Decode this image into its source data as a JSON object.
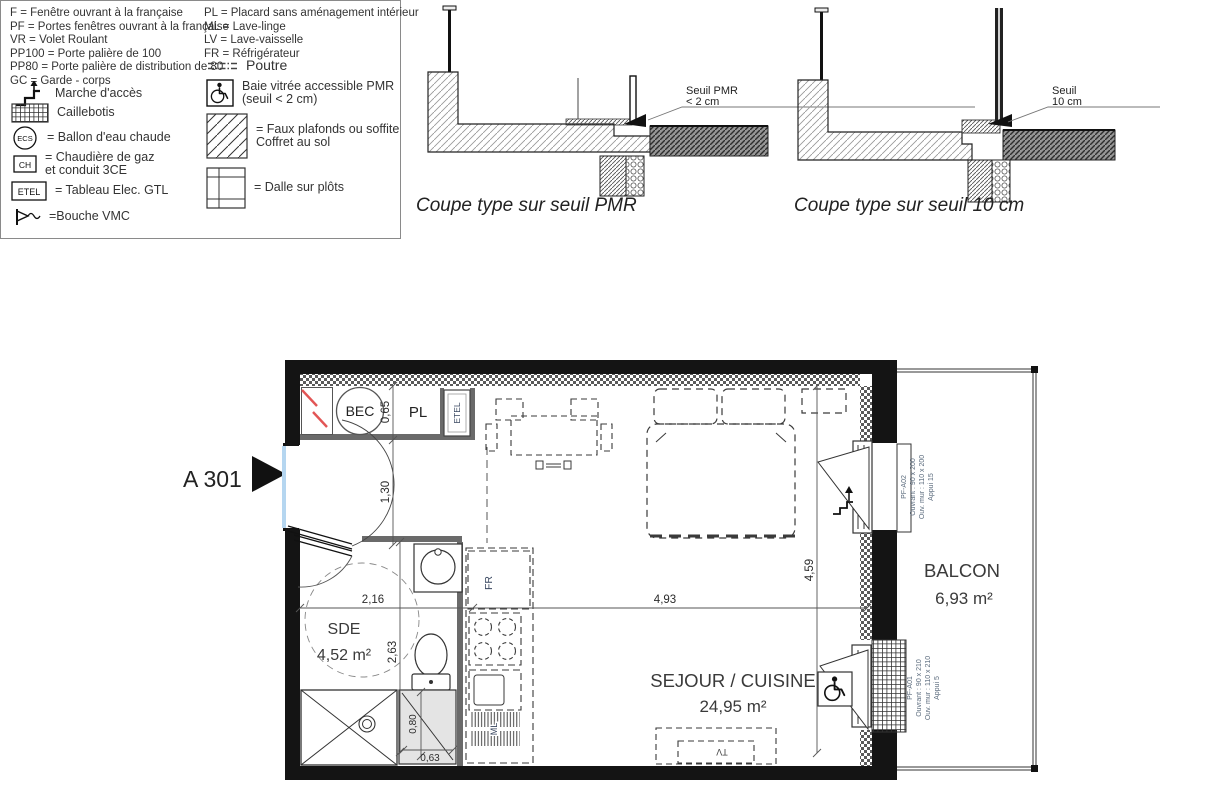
{
  "legend": {
    "abbr_left": [
      "F = Fenêtre ouvrant à la française",
      "PF = Portes fenêtres ouvrant à la française",
      "VR = Volet Roulant",
      "PP100 = Porte palière de 100",
      "PP80 = Porte palière de distribution de 80",
      "GC = Garde - corps"
    ],
    "abbr_right": [
      "PL = Placard sans aménagement intérieur",
      "ML = Lave-linge",
      "LV = Lave-vaisselle",
      "FR = Réfrigérateur"
    ],
    "icon_texts": {
      "ecs": "ECS",
      "ch": "CH",
      "etel": "ETEL"
    },
    "items": {
      "marche": "Marche d'accès",
      "caillebotis": "Caillebotis",
      "ecs": "= Ballon d'eau chaude",
      "ch1": "= Chaudière de gaz",
      "ch2": "et conduit 3CE",
      "etel": "= Tableau Elec. GTL",
      "vmc": "=Bouche VMC",
      "poutre": "Poutre",
      "pmr1": "Baie vitrée accessible PMR",
      "pmr2": "(seuil < 2 cm)",
      "faux1": "= Faux plafonds ou soffite",
      "faux2": "Coffret au sol",
      "dalle": "= Dalle sur plôts"
    }
  },
  "sections": {
    "pmr": {
      "title": "Coupe type sur seuil PMR",
      "callout1": "Seuil PMR",
      "callout2": "< 2 cm"
    },
    "cm10": {
      "title": "Coupe type sur seuil 10 cm",
      "callout1": "Seuil",
      "callout2": "10 cm"
    }
  },
  "plan": {
    "unit_label": "A 301",
    "rooms": {
      "sde": {
        "name": "SDE",
        "area": "4,52 m²"
      },
      "sejour": {
        "name": "SEJOUR / CUISINE",
        "area": "24,95 m²"
      },
      "balcon": {
        "name": "BALCON",
        "area": "6,93 m²"
      }
    },
    "fixtures": {
      "bec": "BEC",
      "pl": "PL",
      "etel": "ETEL",
      "fr": "FR",
      "ml": "ML",
      "tv": "TV"
    },
    "dims": {
      "d065": "0,65",
      "d130": "1,30",
      "d216": "2,16",
      "d263": "2,63",
      "d493": "4,93",
      "d459": "4,59",
      "d080": "0,80",
      "d063": "0,63"
    },
    "windows": {
      "w1": {
        "ref": "PF-A02",
        "l1": "Ouvrant : 90 x 200",
        "l2": "Ouv. mur : 110 x 200",
        "l3": "Appui 15"
      },
      "w2": {
        "ref": "PF-A01",
        "l1": "Ouvrant : 90 x 210",
        "l2": "Ouv. mur : 110 x 210",
        "l3": "Appui 5"
      }
    }
  },
  "colors": {
    "wall": "#141414",
    "red_mark": "#e25555",
    "door_blue": "#b5d6f0",
    "annotation": "#5b6b7d"
  }
}
